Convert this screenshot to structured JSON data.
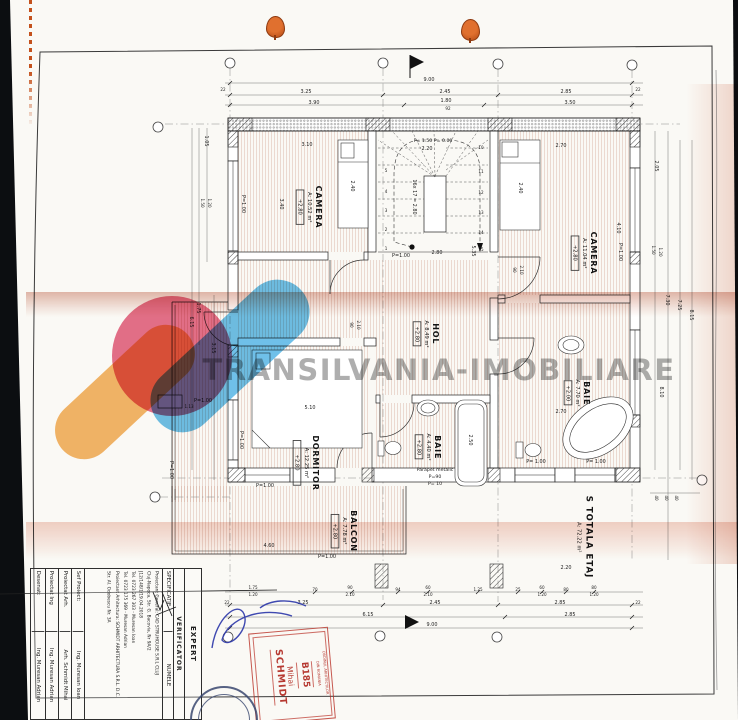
{
  "watermark": {
    "text": "TRANSILVANIA-IMOBILIARE"
  },
  "logo_colors": {
    "orange": "#f3a94e",
    "pink": "#e25877",
    "blue": "#55b5e5"
  },
  "plan": {
    "rooms": {
      "camera_left": {
        "name": "CAMERA",
        "area": "A: 10.52 m²",
        "level": "+2.80"
      },
      "camera_right": {
        "name": "CAMERA",
        "area": "A: 11.04 m²",
        "level": "+2.80"
      },
      "hol": {
        "name": "HOL",
        "area": "A: 8.49 m²",
        "level": "+2.80"
      },
      "baie_small": {
        "name": "BAIE",
        "area": "A: 4.40 m²",
        "level": "+2.80"
      },
      "baie_large": {
        "name": "BAIE",
        "area": "A: 7.70 m²",
        "level": "+2.00"
      },
      "dormitor": {
        "name": "DORMITOR",
        "area": "A: 12.25 m²",
        "level": "+2.80"
      },
      "balcon": {
        "name": "BALCON",
        "area": "A: 7.78 m²",
        "level": "+2.80"
      },
      "total_floor": {
        "name": "S TOTALA ETAJ",
        "area": "A: 72.22 m²"
      }
    },
    "stairs": {
      "formula": "16x 17 = 2.80",
      "top_label": "P= 1.50  P= 0.00",
      "numbers_left": [
        "1",
        "2",
        "3",
        "4",
        "5"
      ],
      "numbers_right": [
        "10",
        "11",
        "12",
        "13",
        "14",
        "15"
      ]
    },
    "labels": {
      "p100": "P=1.00",
      "p100s": "P= 1.00",
      "parapet": [
        "Parapet metalic",
        "P=90",
        "P= 10"
      ]
    },
    "dims": {
      "top_overall": "9.00",
      "top_row2": [
        "3.25",
        "2.45",
        "2.85"
      ],
      "top_row3": [
        "3.90",
        "1.80",
        "3.50"
      ],
      "row3_sub": "92",
      "tick22": "22",
      "bottom_detail": [
        "1.75",
        "1.20",
        "70",
        "90",
        "2.10",
        "94",
        "60",
        "2.10",
        "1.25",
        "25",
        "60",
        "1.20",
        "80",
        "80",
        "1.20"
      ],
      "bottom_row2": [
        "3.25",
        "2.45",
        "2.85"
      ],
      "bottom_row3": [
        "6.15",
        "2.85"
      ],
      "bottom_overall": "9.00",
      "left": [
        "1.05",
        "1.50",
        "1.20",
        "1.75",
        "6.15",
        "3.15"
      ],
      "right": [
        "2.05",
        "1.50",
        "1.20",
        "7.30",
        "7.25",
        "8.15",
        "8.10",
        "40",
        "40",
        "40"
      ],
      "inner": {
        "camera_left_w": "3.10",
        "camera_left_h": "3.40",
        "bed_left": "2.40",
        "bed_right": "2.40",
        "camera_right_w": "2.70",
        "camera_right_h": "4.10",
        "stair_w": "2.20",
        "stair_run": "2.80",
        "stair_side": "5.35",
        "dorm_w": "5.10",
        "dorm_small": "1.13",
        "baie_large_w": "2.70",
        "tub": "2.50",
        "door_w": "90",
        "door_h": "2.10",
        "balcon_w": "4.60",
        "bottom_mid": "2.20"
      }
    }
  },
  "title_block": {
    "expert": "EXPERT",
    "verificator": "VERIFICATOR",
    "specificatie": "SPECIFICATIE",
    "numele": "NUMELE",
    "proiectant_lines": [
      "Proiectant General: CAD STRUHOUSE S.R.L CLUJ",
      "Cluj-Napoca, Str. G. Bacovia, Nr 9A/2",
      "J12/148/1/19.04.2018",
      "Tel. 0723 267 303 - Muresan Ioan",
      "Tel. 0723 175 369 - Muresan Adrian",
      "Proiectant Arhitectura: SCHMIDT ARHITECTURA S.R.L. D.C.",
      "Str. Al. Odobescu Nr. 3A"
    ],
    "rows": [
      {
        "label": "Sef Proiect:",
        "name": "Ing. Muresan Ioan"
      },
      {
        "label": "Proiectat Arh.",
        "name": "Arh. Schmidt Mihai"
      },
      {
        "label": "Proiectat Ing",
        "name": "Ing. Muresan Adrian"
      },
      {
        "label": "Desenat:",
        "name": "Ing. Muresan Adrian"
      }
    ]
  },
  "stamp": {
    "org_line1": "ORDINUL ARHITECTILOR",
    "org_line2": "DIN ROMANIA",
    "number": "B185",
    "first_name": "Mihai",
    "last_name": "SCHMIDT",
    "color": "#c0392b"
  }
}
